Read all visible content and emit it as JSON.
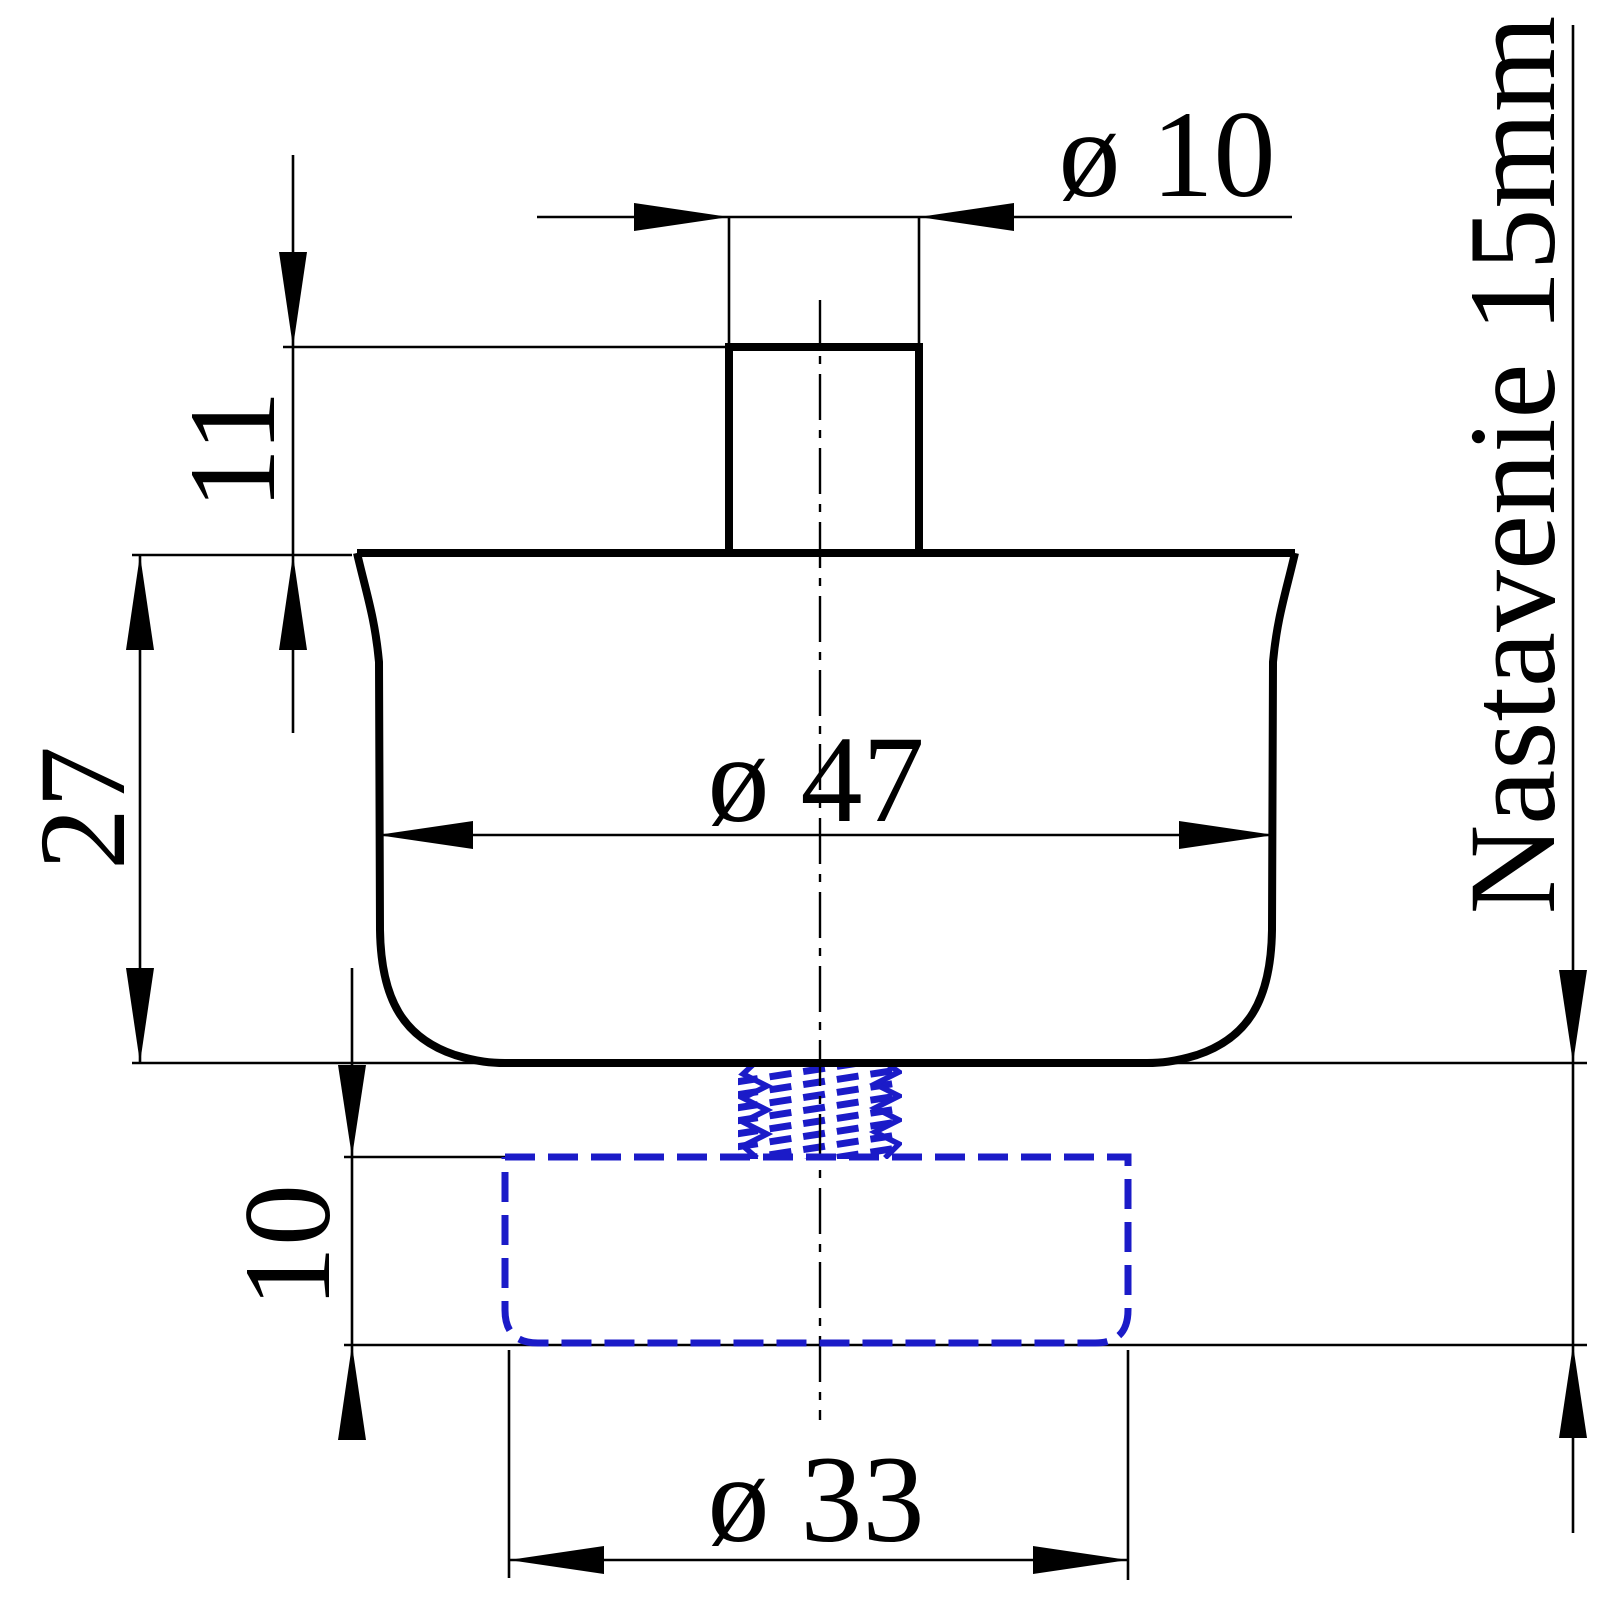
{
  "drawing": {
    "type": "technical-dimension-drawing",
    "part": {
      "visible_outline": "furniture foot body with top stud",
      "hidden_outline": "threaded adjustable foot cap (dashed)"
    },
    "labels": {
      "stud_diameter": "ø 10",
      "stud_height": "11",
      "body_diameter": "ø 47",
      "body_height": "27",
      "foot_height": "10",
      "foot_diameter": "ø 33",
      "adjustment": "Nastavenie 15mm"
    },
    "values": {
      "stud_diameter_mm": 10,
      "stud_height_mm": 11,
      "body_diameter_mm": 47,
      "body_height_mm": 27,
      "foot_height_mm": 10,
      "foot_diameter_mm": 33,
      "adjustment_range_mm": 15
    },
    "colors": {
      "outline": "#000000",
      "hidden_part": "#1b1bc8",
      "background": "#ffffff"
    }
  }
}
